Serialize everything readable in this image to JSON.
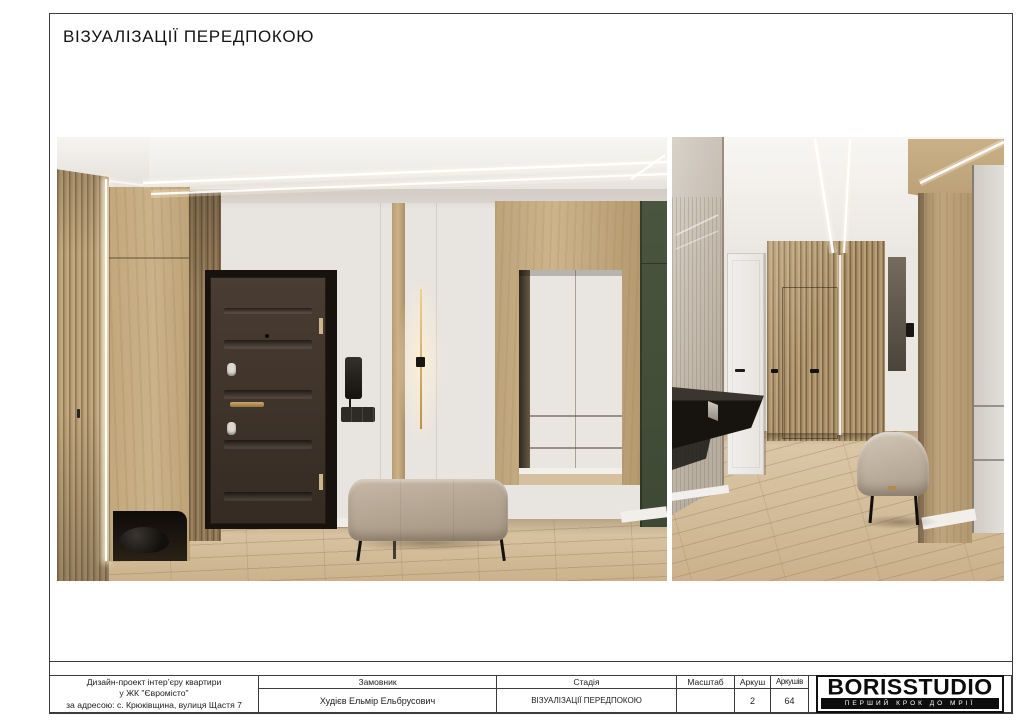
{
  "title": "ВІЗУАЛІЗАЦІЇ ПЕРЕДПОКОЮ",
  "footer": {
    "project": [
      "Дизайн-проект інтер’єру квартири",
      "у ЖК \"Євромісто\"",
      "за адресою: с. Крюківщина, вулиця Щастя 7"
    ],
    "customer_label": "Замовник",
    "customer_value": "Худієв Ельмір Ельбрусович",
    "stage_label": "Стадія",
    "stage_value": "ВІЗУАЛІЗАЦІЇ ПЕРЕДПОКОЮ",
    "scale_label": "Масштаб",
    "scale_value": "",
    "sheet_label": "Аркуш",
    "sheet_value": "2",
    "sheets_label": "Аркушів",
    "sheets_value": "64"
  },
  "logo": {
    "name": "BORISSTUDIO",
    "tagline": "ПЕРШИЙ КРОК ДО МРІЇ"
  },
  "palette": {
    "wall": "#e8e4df",
    "ceiling": "#f7f5f2",
    "wood_light": "#c9b089",
    "wood_slat_dark": "#7b6546",
    "door_dark_brown": "#3f342b",
    "accent_green": "#46523c",
    "floor_oak": "#d9c5a4",
    "bench_beige": "#b3a593",
    "led_light": "#fff8ea",
    "line_black": "#3c3c3c"
  }
}
